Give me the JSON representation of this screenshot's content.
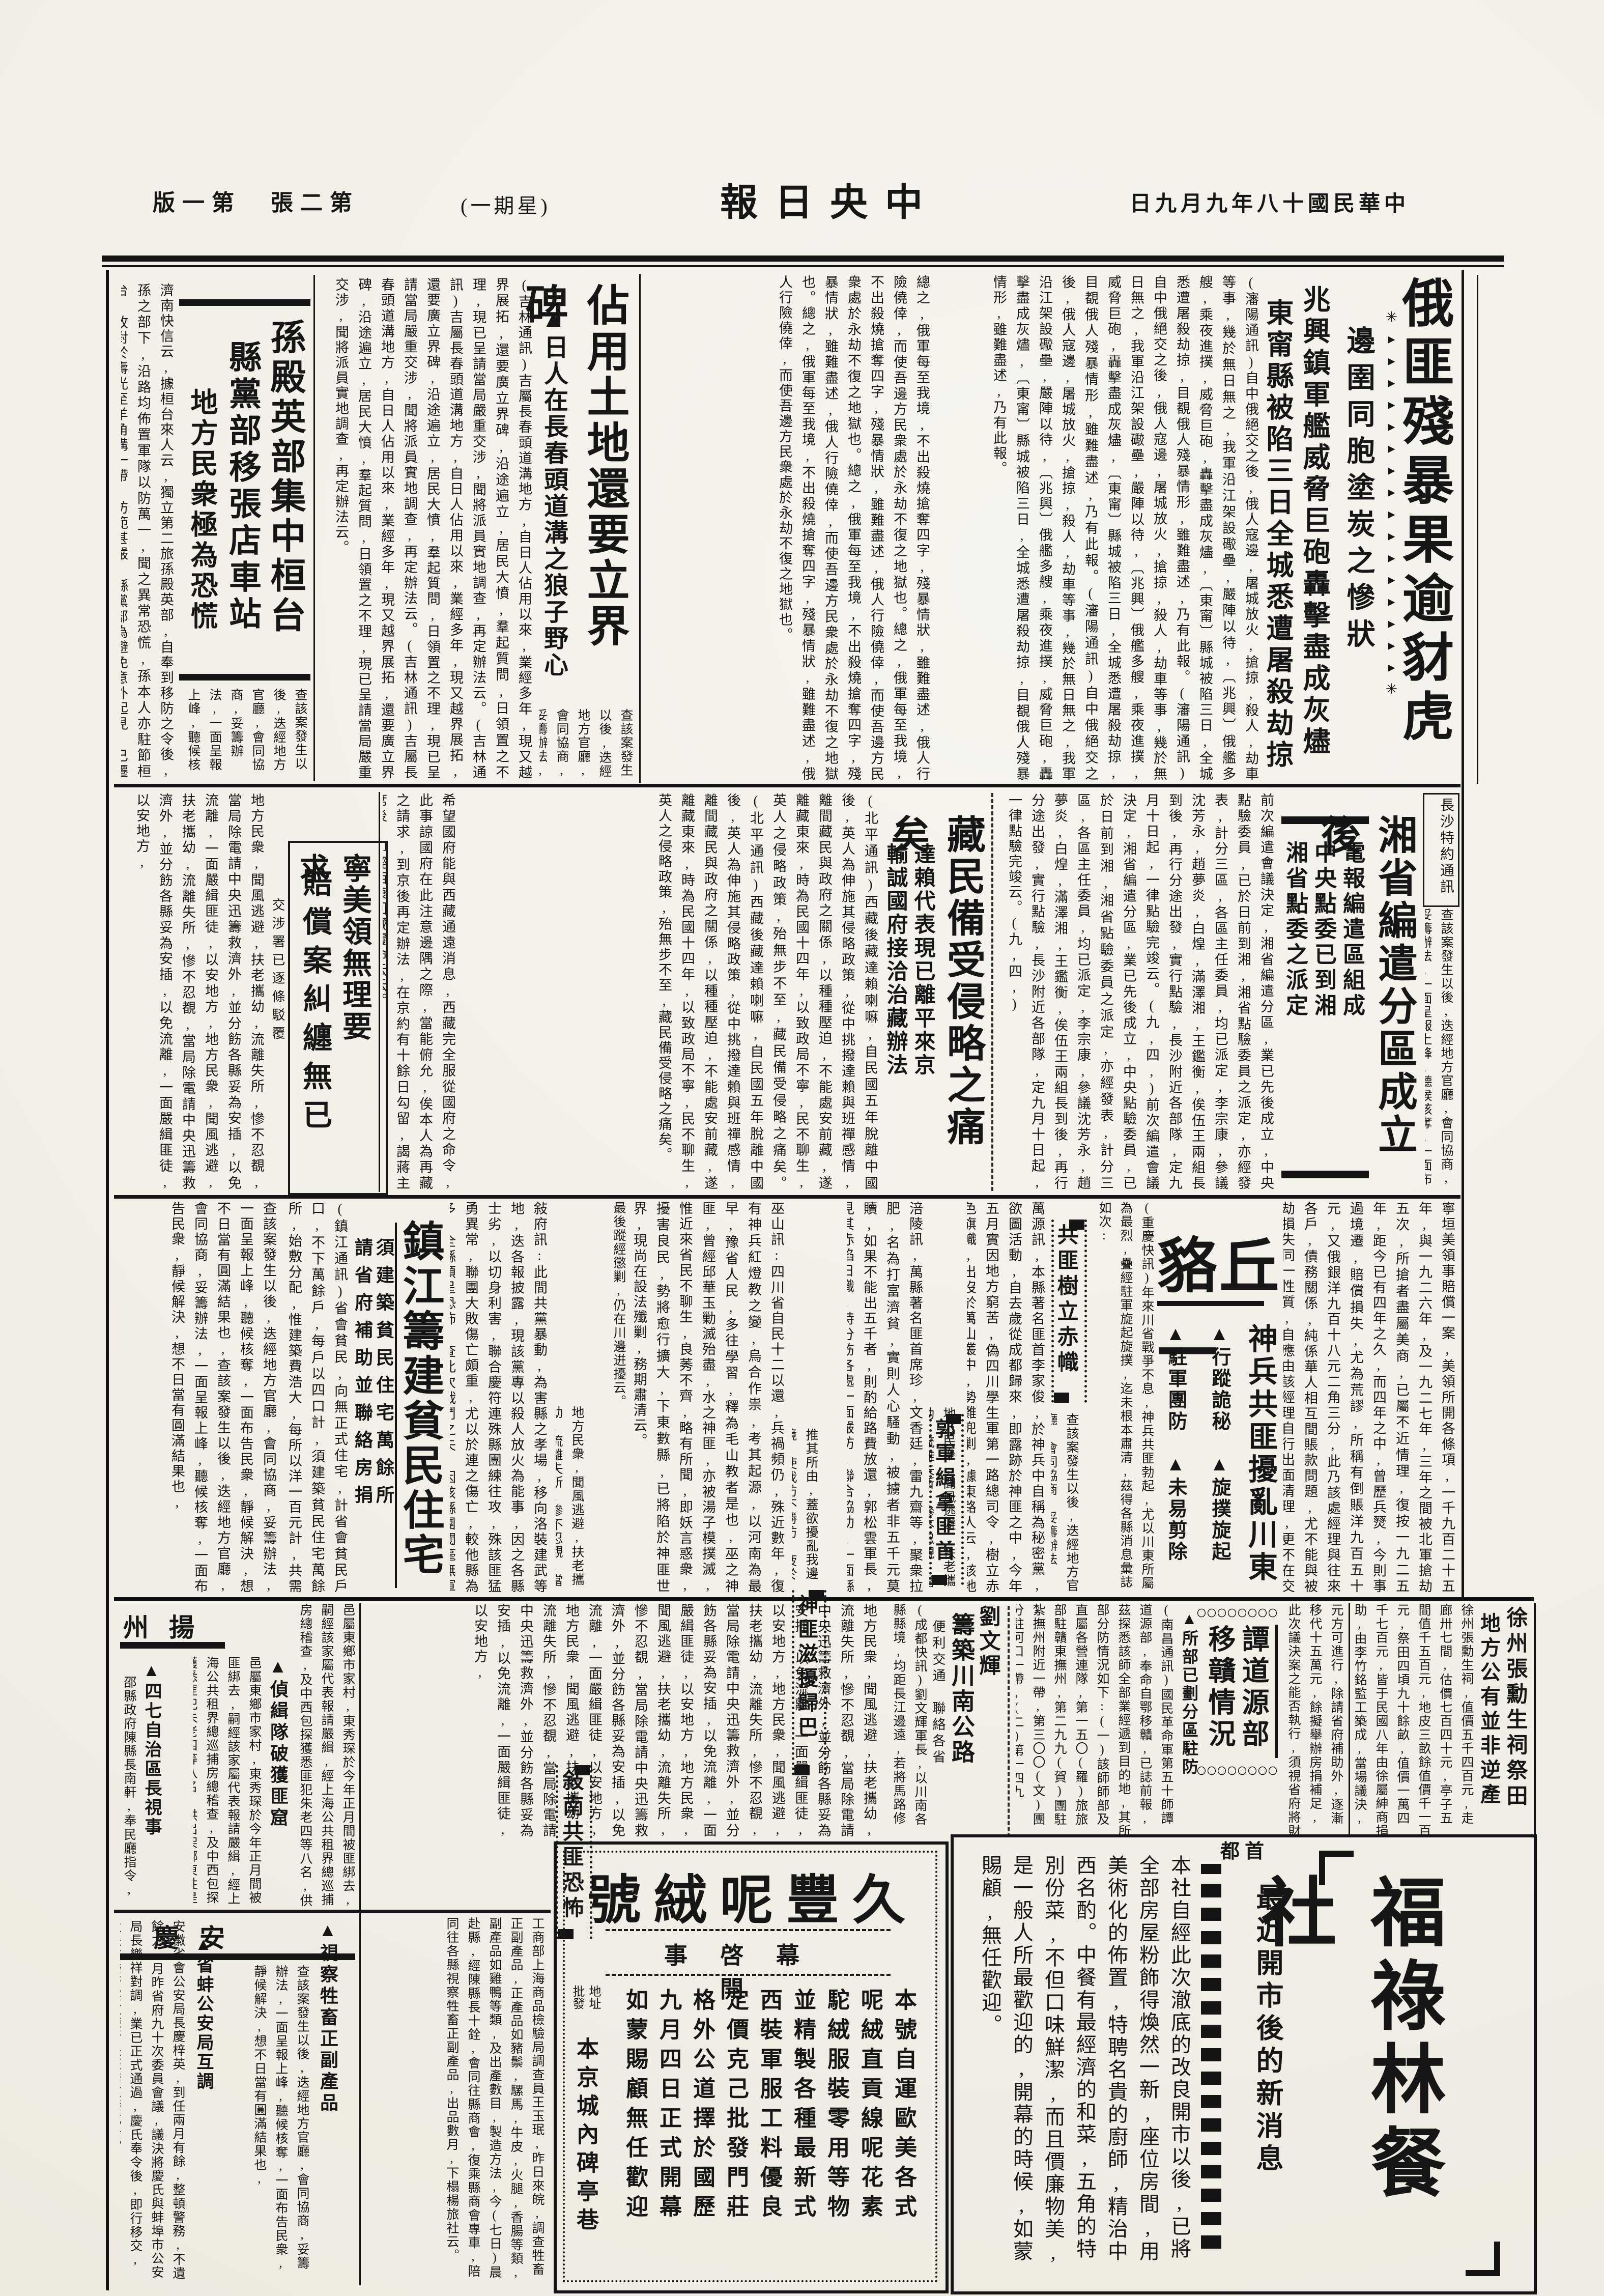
{
  "header": {
    "masthead": "中央日報",
    "date": "中華民國十八年九月九日",
    "weekday": "星期一",
    "edition": "第二張　第一版"
  },
  "articles": {
    "russia": {
      "headline": "俄匪殘暴果逾豺虎",
      "deck": "邊圉同胞塗炭之慘狀",
      "deck_arrows": "✳▸▸▸▸▸▸▸▸▸▸▸▸▸▸▸▸✳",
      "subhead1": "兆興鎮軍艦威脅巨砲轟擊盡成灰燼",
      "subhead2": "東甯縣被陷三日全城悉遭屠殺劫掠",
      "byline": "(瀋陽通訊)",
      "lead": "(瀋陽通訊)自中俄絕交之後,俄人寇邊,屠城放火,搶掠,殺人,劫車等事,幾於無日無之,我軍沿江架設礮壘,嚴陣以待,〔兆興〕俄艦多艘,乘夜進撲,威脅巨砲,轟擊盡成灰燼,〔東甯〕縣城被陷三日,全城悉遭屠殺劫掠,目覩俄人殘暴情形,雖難盡述,乃有此報。",
      "more": "總之,俄軍每至我境,不出殺燒搶奪四字,殘暴情狀,雖難盡述,俄人行險僥倖,而使吾邊方民衆處於永劫不復之地獄也。"
    },
    "zhanyong": {
      "headline": "佔用土地還要立界碑",
      "subhead": "▲日人在長春頭道溝之狼子野心",
      "body": "(吉林通訊)吉屬長春頭道溝地方,自日人佔用以來,業經多年,現又越界展拓,還要廣立界碑,沿途遍立,居民大憤,羣起質問,日領置之不理,現已呈請當局嚴重交涉,聞將派員實地調查,再定辦法云。"
    },
    "sun": {
      "h1": "孫殿英部集中桓台",
      "h2": "縣黨部移張店車站",
      "h3": "地方民衆極為恐慌",
      "body": "濟南快信云,據桓台來人云,獨立第二旅孫殿英部,自奉到移防之令後,孫之部下,沿路均佈置軍隊以防萬一,聞之異常恐慌,孫本人亦駐節桓台,故對於壽光至羊角溝一帶,防範甚嚴,縣黨部為避免意外起見,已遷移張店車站辦公,地方民衆,極為恐慌云。(九,一,)"
    },
    "xiang": {
      "headline": "湘省編遣分區成立後",
      "s1": "電報編遣區組成",
      "s2": "中央點委已到湘",
      "s3": "湘省點委之派定",
      "label": "長沙特約通訊",
      "body": "前次編遣會議決定,湘省編遣分區,業已先後成立,中央點驗委員,已於日前到湘,湘省點驗委員之派定,亦經發表,計分三區,各區主任委員,均已派定,李宗康,參議沈芳永,趙夢炎,白煌,滿澤湘,王鑑衡,俟伍王兩組長到後,再行分途出發,實行點驗,長沙附近各部隊,定九月十日起,一律點驗完竣云。(九,四,)"
    },
    "zang": {
      "headline": "藏民備受侵略之痛矣",
      "s1": "達賴代表現已離平來京",
      "s2": "輸誠國府接洽治藏辦法",
      "body": "(北平通訊)西藏後藏達賴喇嘛,自民國五年脫離中國後,英人為伸施其侵略政策,從中挑撥達賴與班禪感情,離間藏民與政府之關係,以種種壓迫,不能處安前藏,遂離藏東來,時為民國十四年,以致政局不寧,民不聊生,英人之侵略政策,殆無步不至,藏民備受侵略之痛矣。",
      "tail": "希望國府能與西藏通遠消息,西藏完全服從國府之命令,此事諒國府在此注意邊隅之際,當能俯允,俟本人為再藏之請求,到京後再定辦法,在京約有十餘日勾留,謁蔣主席後,即經西康回藏覆命云云。"
    },
    "ningmei": {
      "h1": "寧美領無理要求",
      "h2": "賠償案糾纏無已",
      "side": "交涉署已逐條駁覆",
      "tail": "寧垣美領事賠償一案,美領所開各條項,一千九百二十五年,與一九二六年,及一九二七年,三年之間被北軍搶劫五次,所搶者盡屬美商,已屬不近情理,復按一九二五年,距今已有四年之久,而四年之中,曾歷兵燹,今則事過境遷,賠償損失,尤為荒謬,所稱有倒賬洋九百五十元,又俄銀洋九百十八元二角三分,此乃該處經理與往來各戶,債務關係,純係華人相互間賬款問題,尤不能與被劫損失同一性質,自應由該經理自行出面清理,更不在交涉範圍之內,交涉署接到此項無理要求賠償函件,已三次逐條駁拒矣。"
    },
    "qiuhe": {
      "title": "一丘貉",
      "big": "神兵共匪擾亂川東",
      "s1": "▲行蹤詭秘　▲旋撲旋起",
      "s2": "▲駐軍團防　▲未易剪除",
      "body": "(重慶快訊)年來川省戰爭不息,神兵共匪勃起,尤以川東所屬為最烈,疊經駐軍旋起旋撲,迄未根本肅清,茲得各縣消息彙誌如次:"
    },
    "chizhi": {
      "head": "共匪樹立赤幟",
      "body": "萬源訊,本縣著名匪首李家俊,於神兵中自稱為秘密黨,欲圖活動,自去歲從成都歸來,即露跡於神匪之中,今年五月實因地方窮苦,偽四川學生軍第一路總司令,樹立赤色旗幟,出沒於萬山叢中,勢難兜剿,據東路人云,該地有槍四五百支,勢將愈行擴大,已頗不易撲滅,駐軍聞訊,特派遣大部前往圍剿,現聞該匪已大敗竄逃,尚在設法殲剿,務期肅清云。"
    },
    "guo": {
      "head": "郭軍緝拿匪首",
      "body": "涪陵訊,萬縣著名匪首席珍,文香廷,雷九齋等,聚衆拉肥,名為打富濟貧,實則人心騷動,被擄者非五千元莫贖,如果不能出五千者,則酌給路費放還,郭松雲軍長,見其赤焰日熾,特分飭各處一面嚴防,聯合協助,一面縣賞緝拿,如擊斃著名匪首一名,獎洋三千元,佈告一出,軍團踴躍,聞該匪等已聞風逃竄云。"
    },
    "shenfei": {
      "head": "神匪滋擾歸巴",
      "body": "巫山訊:四川省自民十二以還,兵禍頻仍,殊近數年,復有神兵紅燈教之變,烏合作祟,考其起源,以河南為最早,豫省人民,多往學習,釋為毛山教者是也,巫之神匪,曾經邱華玉勦滅殆盡,水之神匪,亦被湯子模撲滅,惟近來省民不聊生,良莠不齊,略有所聞,即妖言惑衆,擾害良民,勢將愈行擴大,下東數縣,已將陷於神匪世界,現尚在設法殲剿,務期肅清云。"
    },
    "xunan": {
      "head": "敍南共匪恐怖",
      "tail": "最後蹤經懲剿,仍在川邊逬擾云。",
      "body": "敍府訊:此間共黨暴動,為害縣之孝場,移向洛裝建武等地,迭各報披露,現該黨專以殺人放火為能事,因之各縣士劣,以切身利害,聯合慶符連殊縣團練往攻,殊該匪猛勇異常,聯團大敗傷亡頗重,尤以於連之傷亡,較他縣為多,全縣頓呈恐怖,查此次戰鬥之失,因該縣團閥毫無軍事常識,且平時吞蝕國款,此次派遣之任務,概係富紳子弟,該丁等之父兄,平昔素受團防之剝削,茲竟逼令不敢面戰,使青年子弟供無謂犧牲,聞將向政府提出訴訟云。(亞光社)"
    },
    "zhenjiang": {
      "headline": "鎮江籌建貧民住宅",
      "s1": "須建築貧民住宅萬餘所",
      "s2": "請省府補助並聯絡房捐",
      "body": "(鎮江通訊)省會貧民,向無正式住宅,計省會貧民戶口,不下萬餘戶,每戶以四口計,須建築貧民住宅萬餘所,始敷分配,惟建築費浩大,每所以洋一百元計,共需洋百萬元,擬請省府補助,並聯絡房捐,籌集的款,剋日興工云。",
      "tail": "元方可進行,除請省府補助外,逐漸移代十五萬元,餘擬舉辦房捐補足,此次議決案之能否執行,須視省府將財政解決後也。"
    },
    "tan": {
      "h1": "譚道源部",
      "h2": "移贛情況",
      "sub": "▲所部已劃分區駐防",
      "deco": "〇〇〇〇〇〇〇〇",
      "body": "(南昌通訊)國民革命軍第五十師譚道源部,奉命自鄂移贛,已誌前報,茲探悉該師全部業經遞到目的地,其所部分防情況如下:(一)該師師部及直屬各營連隊,第一五〇(羅)旅旅部駐贛東撫州,第二九九(賀)團駐紮撫州附近一帶,第三〇〇(文)團分駐河口一帶,(二)第一四九(岳)旅部及二九八(周)團駐贛南吉安一帶,第二九七(朱)團駐德安一帶,(三)第一四八(成)旅旅部及二九五(黃)團駐紮贛東北景德鎮一帶,聞該師由鄂移贛,行軍紀律甚佳。(九,五,)"
    },
    "liu": {
      "name": "劉文輝",
      "headline": "籌築川南公路",
      "sub": "便利交通　聯絡各省",
      "body": "(成都快訊)劉文輝軍長,以川南各縣縣境,均距長江邊遠,若將馬路修理完善,不僅對於軍事運輸便利,即人民交通,亦稱便利,因決籌築川南公路,聯絡各省,現已著手測量云。"
    },
    "xuzhou": {
      "h1": "徐州張勳生祠祭田",
      "h2": "地方公有並非逆產",
      "body": "徐州張勳生祠,值價五千四百元,走廊卅七間,估價七百四十元,亭子五間值千五百元,地皮三畝餘值價千一百元,祭田四頃九十餘畝,值價一萬四千七百元,皆于民國八年由徐屬紳商捐助,由李竹銘監工築成,當場議決,各機關聯名兩請縣府保留,其理由一,該項產業本屬地方所有,實非張勳逆產,一,該祠已改為烈士祠之用,一,該祠房屋及祭田除烈士祠應留一部外,餘均撥歸救濟院,院址及經費用途,並擬電省府說明。"
    }
  },
  "sections": {
    "yangzhou": {
      "header": "揚州",
      "i1": "▲偵緝隊破獲匪窟",
      "b1": "邑屬東鄉市家村,東秀琛於今年正月間被匪綁去,嗣經該家屬代表報請嚴緝,經上海公共租界總巡捕房總稽查,及中西包探獲悉匪犯朱老四等八名,供出架綁東姓是實,當由東姓呈請鎮江省會公安局偵緝隊,救護肉票,速捕餘匪,該隊乃尋蹤躡跡,率隊長三十餘名,於五日夜三時乘船至東家村二元莊,探悉鄰匪巢穴,救出肉票東秀琛,並獲嫌疑犯一名。",
      "i2": "▲四七自治區長視事",
      "b2": "邵縣政府陳縣長南軒,奉民廳指令,委王壽山,為自治第四區區長,該區轄境遼闊,聞王已於日前到區視事云。"
    },
    "anqing": {
      "header": "安慶",
      "i1": "▲視察牲畜正副產品",
      "b1": "工商部上海商品檢驗局調查員王玉珉,昨日來皖,調查牲畜正副產品,正產品如豬鬃,騾馬,牛皮,火腿,香腸等類,副產品如雞鴨等類,及出產數目,製造方法,今(七日)晨赴縣,經陳縣長十銓,會同往縣商會,復乘縣商會專車,陪同往各縣視察牲畜正副產品,出品數月,下榻楊旅社云。",
      "i2": "▲省蚌公安局互調",
      "b2": "安徽省會公安局長慶梓英,到任兩月有餘,整頓警務,不遺餘力,月昨省府九十次委員會議,議決將慶氏與蚌埠市公安局長樂祥對調,業已正式通過,慶氏奉令後,即行移交,遺缺改委警察教練所長汪浩文接充云。"
    }
  },
  "ads": {
    "jiufeng": {
      "title": "久豐呢絨號",
      "subtitle": "開幕啓事",
      "lines": [
        "本號自運歐美各式",
        "呢絨直貢線呢花素",
        "駝絨服裝零用等物",
        "並精製各種最新式",
        "西裝軍服工料優良",
        "定價克己批發門莊",
        "格外公道擇於國歷",
        "九月四日正式開幕",
        "如蒙賜顧無任歡迎"
      ],
      "addr_label1": "地址",
      "addr_label2": "批發",
      "address": "本京城內碑亭巷"
    },
    "fulin": {
      "region": "首都",
      "title": "福祿林餐社",
      "subhead": "最近開市後的新消息",
      "body": "本社自經此次澈底的改良開市以後,已將全部房屋粉飾得煥然一新,座位房間,用美術化的佈置,特聘名貴的廚師,精治中西名酌。中餐有最經濟的和菜,五角的特別份菜,不但口味鮮潔,而且價廉物美,是一般人所最歡迎的,開幕的時候,如蒙賜顧,無任歡迎。"
    }
  },
  "filler": {
    "a": "推其所由,蓋欲擾亂我邊境,使我防不勝防,疲於奔命,以逞其陰謀也,此種殘暴行為,稍具人心者,莫不髮指,俄匪殘暴,果逾豺虎,邊圉同胞,塗炭之慘,報紙所載,十不及一,",
    "b": "地方民衆,聞風逃避,扶老攜幼,流離失所,慘不忍覩,當局除電請中央迅籌救濟外,並分飭各縣妥為安插,以免流離,一面嚴緝匪徒,以安地方,",
    "c": "查該案發生以後,迭經地方官廳,會同協商,妥籌辦法,一面呈報上峰,聽候核奪,一面布告民衆,靜候解決,想不日當有圓滿結果也,"
  },
  "colors": {
    "ink": "#161616",
    "paper": "#f2efe7"
  }
}
